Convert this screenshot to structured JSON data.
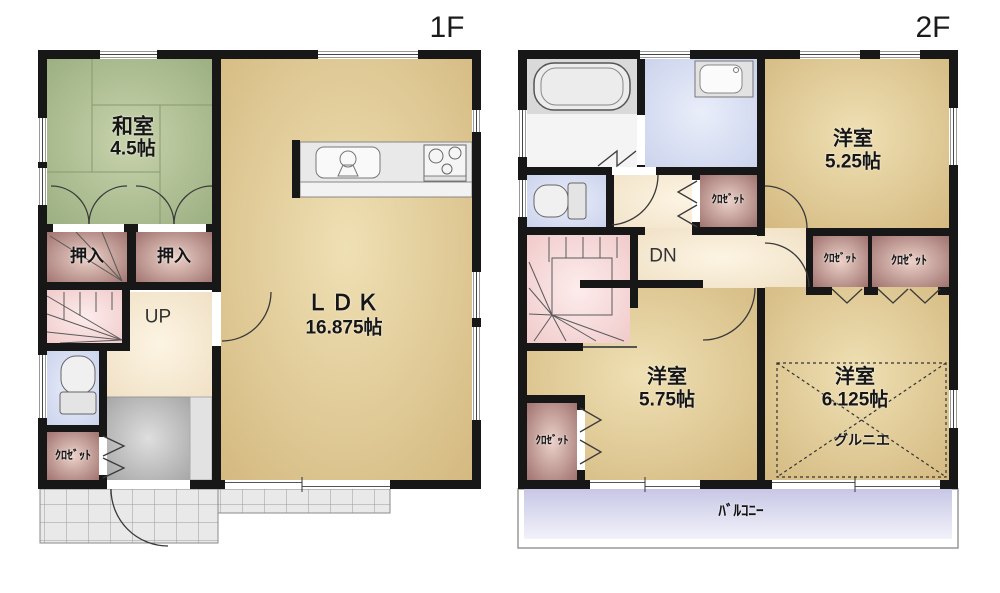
{
  "f1": {
    "title": "1F",
    "washitsu_name": "和室",
    "washitsu_size": "4.5帖",
    "ldk_name": "ＬＤＫ",
    "ldk_size": "16.875帖",
    "oshiire1": "押入",
    "oshiire2": "押入",
    "up": "UP",
    "closet": "ｸﾛｾﾞｯﾄ"
  },
  "f2": {
    "title": "2F",
    "room525_name": "洋室",
    "room525_size": "5.25帖",
    "room575_name": "洋室",
    "room575_size": "5.75帖",
    "room6125_name": "洋室",
    "room6125_size": "6.125帖",
    "dn": "DN",
    "closet_mid": "ｸﾛｾﾞｯﾄ",
    "closet_right1": "ｸﾛｾﾞｯﾄ",
    "closet_right2": "ｸﾛｾﾞｯﾄ",
    "closet_bottom": "ｸﾛｾﾞｯﾄ",
    "grenier": "グルニエ",
    "balcony": "ﾊﾞﾙｺﾆｰ"
  },
  "colors": {
    "wall": "#171717",
    "ldk_floor": "#d8bd85",
    "tatami": "#aabd90",
    "closet": "#b98c86",
    "stairs": "#f5d2d2",
    "hall": "#f5e7cd",
    "water_room": "#d8dff3",
    "genkan": "#b5b5b5",
    "balcony": "#d6d6ee",
    "tile": "#e9e9e9"
  }
}
